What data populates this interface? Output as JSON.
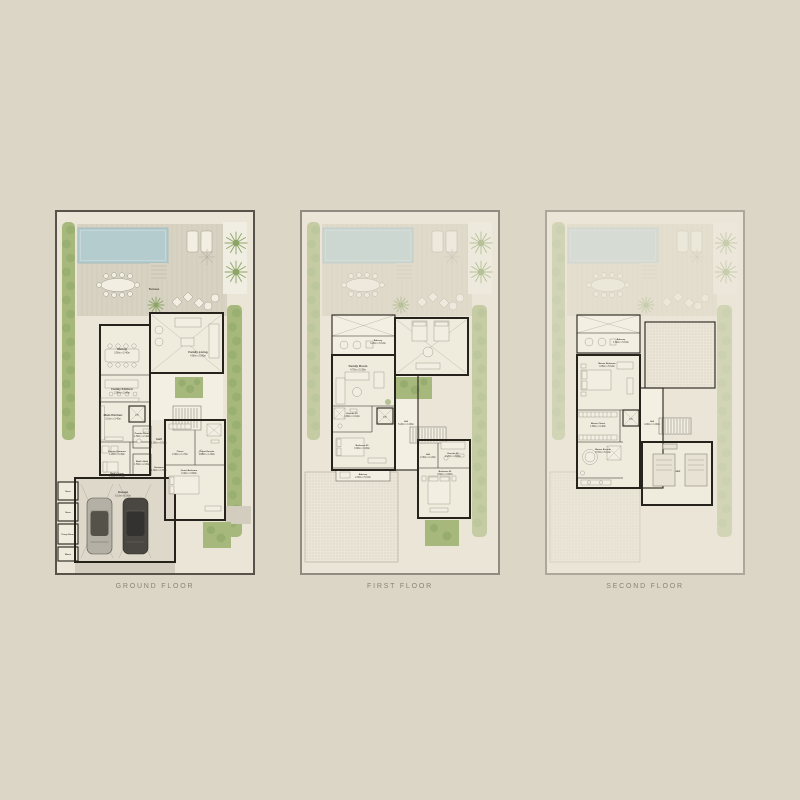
{
  "page": {
    "background": "#dcd6c7"
  },
  "colors": {
    "bg": "#dcd6c7",
    "paper": "#eae5d6",
    "frame_ground": "#57534b",
    "frame_first": "#8f8b81",
    "frame_second": "#aba79b",
    "wall": "#26221c",
    "room": "#efebdd",
    "room_lt": "#f3efe2",
    "garage": "#ddd8c9",
    "pool": "#b5cccf",
    "pool_edge": "#9fb9be",
    "green": "#a7b87d",
    "green_dark": "#8ca567",
    "deck": "#d7d2c2",
    "deck_line": "#c9c4b4",
    "furniture": "#f2eee1",
    "furniture_line": "#9b968a",
    "ink": "#46423a",
    "caption": "#8b8374",
    "stipple": "#c5c0b2",
    "driveway": "#d2cdbe"
  },
  "floors": [
    {
      "caption": "GROUND FLOOR",
      "rooms": {
        "terrace": {
          "label": "Terrace"
        },
        "dining": {
          "label": "Dining",
          "dims": "3.50m x 5.40m"
        },
        "family_living": {
          "label": "Family Living",
          "dims": "4.80m x 5.80m"
        },
        "family_kitchen": {
          "label": "Family Kitchen",
          "dims": "2.95m x 5.40m"
        },
        "main_kitchen": {
          "label": "Main Kitchen",
          "dims": "3.10m x 3.40m"
        },
        "lift": {
          "label": "Lift"
        },
        "hall": {
          "label": "Hall",
          "dims": "1.80m x 5.00m"
        },
        "powder_room": {
          "label": "Powder Room",
          "dims": "1.50m x 2.40m"
        },
        "service_entrance": {
          "label": "Service Entrance",
          "dims": "1.20m x 3.45m"
        },
        "maids_bath": {
          "label": "Maid's Bath",
          "dims": "1.50m x 2.20m"
        },
        "maids_room": {
          "label": "Maid's Room",
          "dims": "2.10m x 3.45m"
        },
        "entrance": {
          "label": "Entrance",
          "dims": "1.80m x 1.50m"
        },
        "garage": {
          "label": "Garage",
          "dims": "6.10m x 6.00m"
        },
        "store1": {
          "label": "Store"
        },
        "store2": {
          "label": "Store"
        },
        "pump_room": {
          "label": "Pump Room"
        },
        "waste": {
          "label": "Waste"
        },
        "closet": {
          "label": "Closet",
          "dims": "2.30m x 1.70m"
        },
        "guest_ensuite": {
          "label": "Guest Ensuite",
          "dims": "2.95m x 1.90m"
        },
        "guest_bedroom": {
          "label": "Guest Bedroom",
          "dims": "3.40m x 3.80m"
        }
      }
    },
    {
      "caption": "FIRST FLOOR",
      "rooms": {
        "balcony": {
          "label": "Balcony",
          "dims": "3.20m x 5.10m"
        },
        "family_room": {
          "label": "Family Room",
          "dims": "4.75m x 5.35m"
        },
        "ensuite03": {
          "label": "Ensuite 03",
          "dims": "1.80m x 3.10m"
        },
        "lift": {
          "label": "Lift"
        },
        "hall": {
          "label": "Hall",
          "dims": "5.20m x 1.80m"
        },
        "bedroom03": {
          "label": "Bedroom 03",
          "dims": "3.30m x 3.00m"
        },
        "balcony2": {
          "label": "Balcony",
          "dims": "2.00m x 5.10m"
        },
        "hall2": {
          "label": "Hall",
          "dims": "2.45m x 1.20m"
        },
        "ensuite02": {
          "label": "Ensuite 02",
          "dims": "2.20m x 2.45m"
        },
        "bedroom02": {
          "label": "Bedroom 02",
          "dims": "3.50m x 3.80m"
        }
      }
    },
    {
      "caption": "SECOND FLOOR",
      "rooms": {
        "balcony": {
          "label": "Balcony",
          "dims": "1.50m x 5.10m"
        },
        "master_bedroom": {
          "label": "Master Bedroom",
          "dims": "4.05m x 5.10m"
        },
        "master_closet": {
          "label": "Master Closet",
          "dims": "1.80m x 3.40m"
        },
        "lift": {
          "label": "Lift"
        },
        "hall": {
          "label": "Hall",
          "dims": "4.00m x 1.80m"
        },
        "master_ensuite": {
          "label": "Master Ensuite",
          "dims": "2.70m x 5.10m"
        },
        "mep": {
          "label": "MEP"
        }
      }
    }
  ]
}
